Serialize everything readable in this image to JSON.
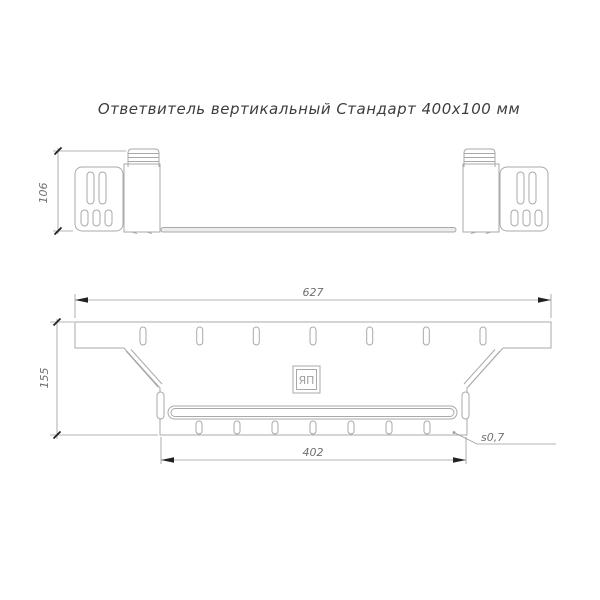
{
  "title": "Ответвитель вертикальный Стандарт 400х100 мм",
  "drawing": {
    "side_view": {
      "label": "side view of vertical branch connector",
      "dim_height_mm": "106"
    },
    "plan_view": {
      "label": "plan view of vertical branch connector",
      "dim_overall_width_mm": "627",
      "dim_side_height_mm": "155",
      "dim_branch_width_mm": "402",
      "thickness_note": "s0,7"
    },
    "logo_text": "ЯП"
  },
  "colors": {
    "background": "#ffffff",
    "outline": "#a9a9a9",
    "dimension_line": "#9a9a9a",
    "dimension_text": "#6f6f6f",
    "title_text": "#3d3d3d",
    "arrow_tick": "#222222"
  }
}
